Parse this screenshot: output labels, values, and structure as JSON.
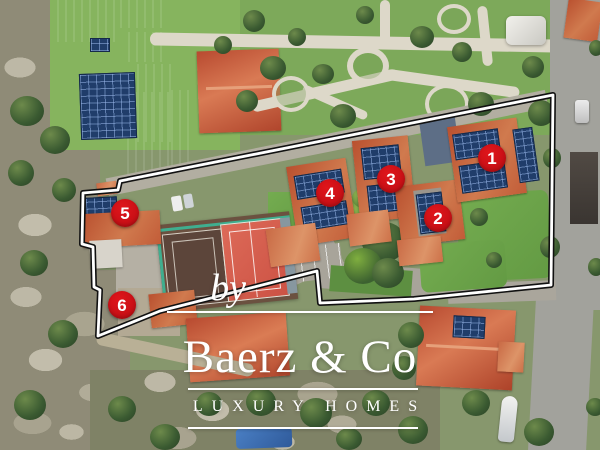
{
  "overlay": {
    "watermark": {
      "by": "by",
      "name": "Baerz & Co",
      "tagline": "LUXURY HOMES"
    },
    "markers": [
      {
        "label": "1",
        "x": 492,
        "y": 158
      },
      {
        "label": "2",
        "x": 438,
        "y": 218
      },
      {
        "label": "3",
        "x": 391,
        "y": 179
      },
      {
        "label": "4",
        "x": 330,
        "y": 193
      },
      {
        "label": "5",
        "x": 125,
        "y": 213
      },
      {
        "label": "6",
        "x": 122,
        "y": 305
      }
    ],
    "boundary": {
      "points": "553,95 120,181 118,190 83,193 82,244 93,247 94,287 100,290 98,336 160,311 317,271 320,303 414,299 551,285",
      "stroke_outer": "#111111",
      "stroke_inner": "#ffffff"
    },
    "colors": {
      "marker_red": "#e0151b",
      "marker_text": "#ffffff",
      "watermark": "#ffffff"
    }
  }
}
